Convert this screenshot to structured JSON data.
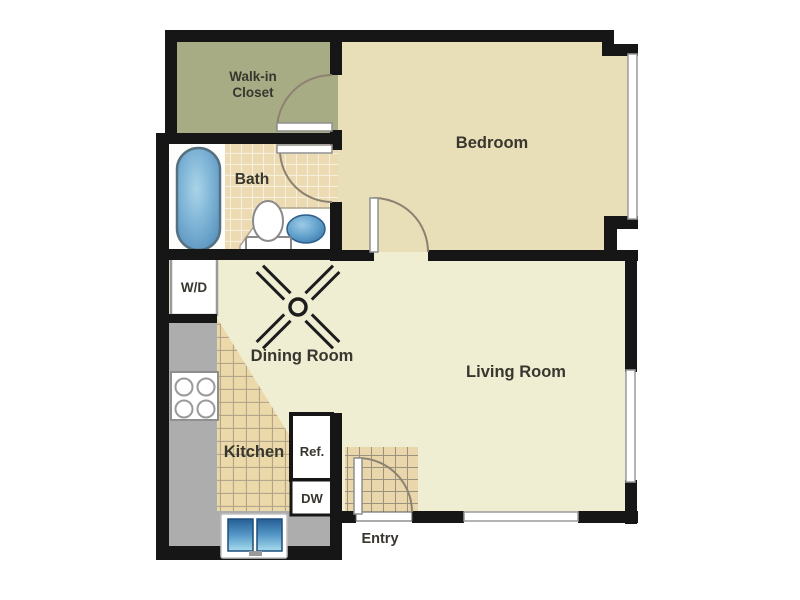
{
  "rooms": {
    "walk_in_closet": {
      "label_line1": "Walk-in",
      "label_line2": "Closet"
    },
    "bedroom": {
      "label": "Bedroom"
    },
    "bath": {
      "label": "Bath"
    },
    "washer_dryer": {
      "label": "W/D"
    },
    "dining_room": {
      "label": "Dining Room"
    },
    "living_room": {
      "label": "Living Room"
    },
    "kitchen": {
      "label": "Kitchen"
    },
    "refrigerator": {
      "label": "Ref."
    },
    "dishwasher": {
      "label": "DW"
    },
    "entry": {
      "label": "Entry"
    }
  },
  "colors": {
    "wall": "#161616",
    "closet_floor": "#a8ac84",
    "bedroom_floor": "#e8deb7",
    "living_dining_floor": "#efeed3",
    "bath_floor_white": "#fdfdfc",
    "bath_tile": "#ebdab2",
    "kitchen_tile": "#ecd9a9",
    "entry_tile": "#e9d7ab",
    "counter_gray": "#adadad",
    "appliance_white": "#ffffff",
    "fixture_blue_light": "#a9d4e8",
    "fixture_blue_dark": "#30699c",
    "door_arc": "#8d8271",
    "label_text": "#38362e"
  },
  "fixtures": {
    "ceiling_fan": "ceiling-fan-icon",
    "bathtub": "bathtub-icon",
    "toilet": "toilet-icon",
    "bath_sink": "bath-sink-icon",
    "kitchen_sink": "kitchen-sink-icon",
    "stove": "stove-burners-icon",
    "washer_dryer_unit": "washer-dryer-box",
    "refrigerator_unit": "refrigerator-box",
    "dishwasher_unit": "dishwasher-box"
  }
}
